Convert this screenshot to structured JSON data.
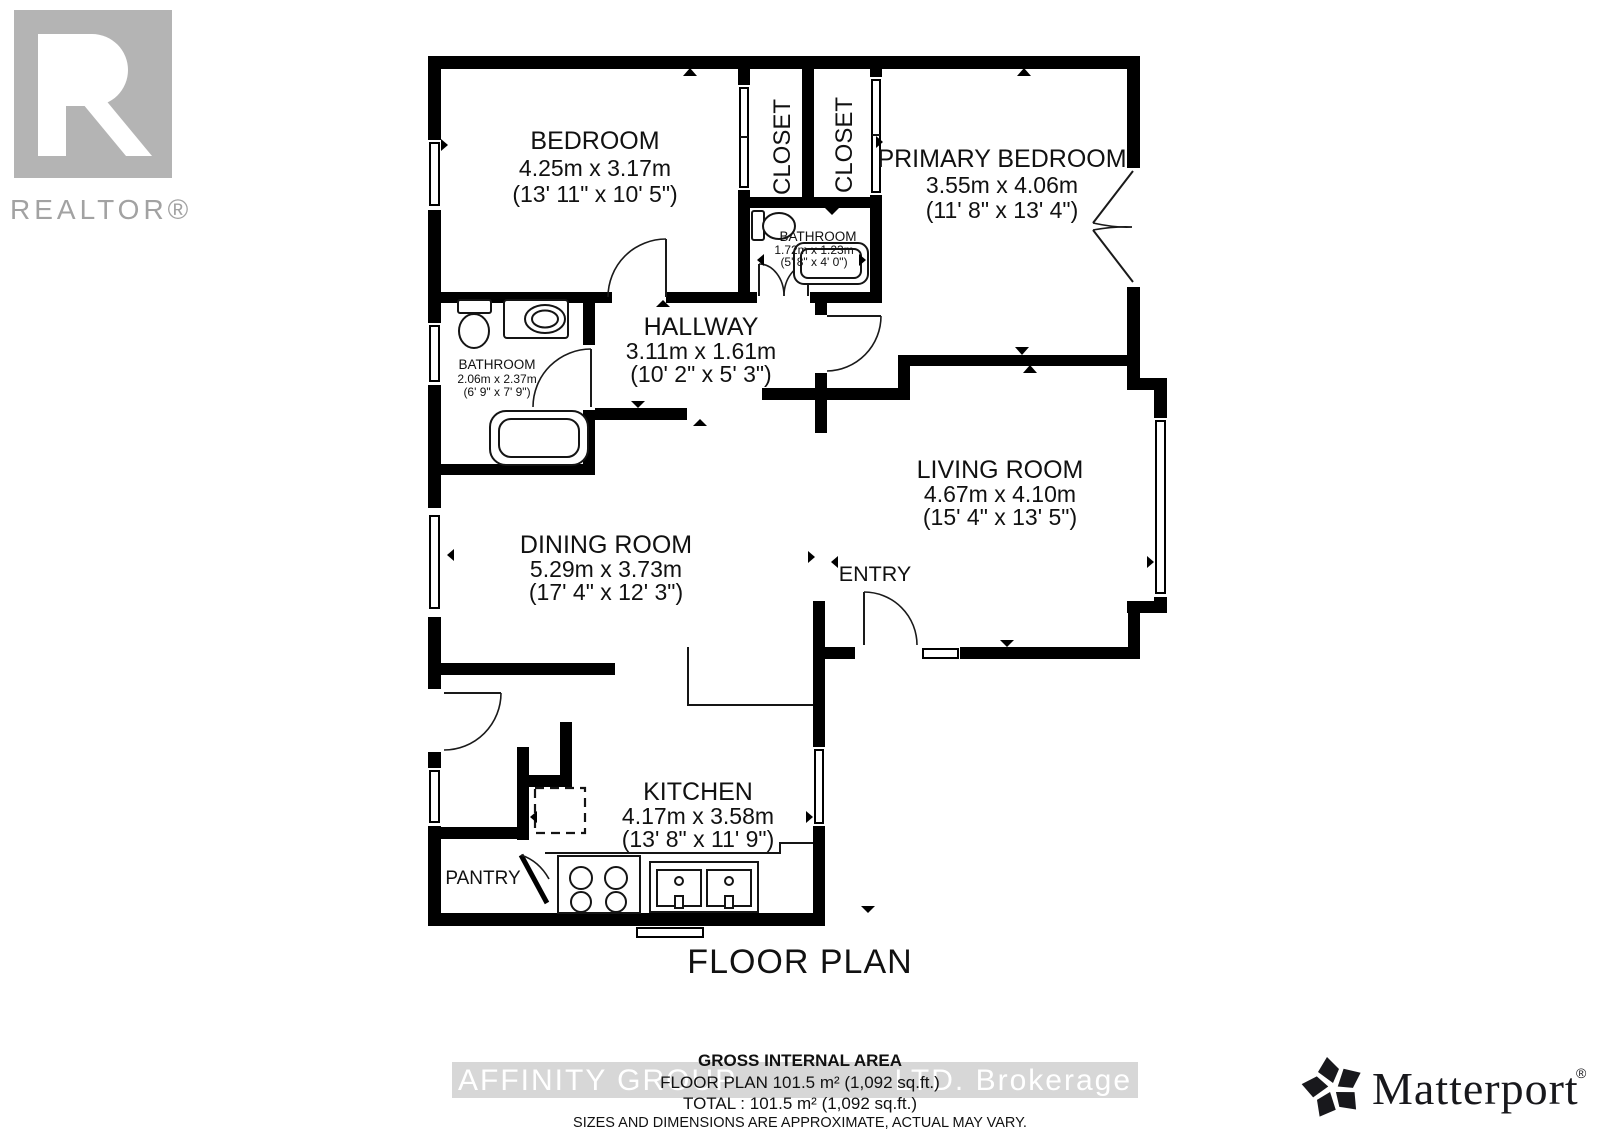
{
  "title": "FLOOR PLAN",
  "branding": {
    "realtor": {
      "wordmark": "REALTOR®"
    },
    "matterport": {
      "wordmark": "Matterport",
      "reg": "®"
    }
  },
  "rooms": {
    "bedroom": {
      "name": "BEDROOM",
      "dim_m": "4.25m x 3.17m",
      "dim_ft": "(13' 11\" x 10' 5\")"
    },
    "primary_bedroom": {
      "name": "PRIMARY BEDROOM",
      "dim_m": "3.55m x 4.06m",
      "dim_ft": "(11' 8\" x 13' 4\")"
    },
    "hallway": {
      "name": "HALLWAY",
      "dim_m": "3.11m x 1.61m",
      "dim_ft": "(10' 2\" x 5' 3\")"
    },
    "bathroom_ensuite": {
      "name": "BATHROOM",
      "dim_m": "1.72m x 1.23m",
      "dim_ft": "(5' 8\" x 4' 0\")"
    },
    "bathroom_main": {
      "name": "BATHROOM",
      "dim_m": "2.06m x 2.37m",
      "dim_ft": "(6' 9\" x 7' 9\")"
    },
    "living_room": {
      "name": "LIVING ROOM",
      "dim_m": "4.67m x 4.10m",
      "dim_ft": "(15' 4\" x 13' 5\")"
    },
    "dining_room": {
      "name": "DINING ROOM",
      "dim_m": "5.29m x 3.73m",
      "dim_ft": "(17' 4\" x 12' 3\")"
    },
    "kitchen": {
      "name": "KITCHEN",
      "dim_m": "4.17m x 3.58m",
      "dim_ft": "(13' 8\" x 11' 9\")"
    }
  },
  "labels": {
    "closet_1": "CLOSET",
    "closet_2": "CLOSET",
    "entry": "ENTRY",
    "pantry": "PANTRY"
  },
  "summary": {
    "heading": "GROSS INTERNAL AREA",
    "floor_plan_line": "FLOOR PLAN 101.5 m² (1,092 sq.ft.)",
    "total_line": "TOTAL :  101.5 m² (1,092 sq.ft.)",
    "disclaimer": "SIZES AND DIMENSIONS ARE APPROXIMATE, ACTUAL MAY VARY."
  },
  "watermark": {
    "left": "AFFINITY GROUP",
    "right": "LTD.  Brokerage"
  },
  "colors": {
    "wall": "#000000",
    "logo_gray": "#b4b4b4",
    "logo_text_gray": "#a2a2a2",
    "watermark_band": "#d7d7d7",
    "watermark_text": "#ffffff",
    "text": "#111111",
    "matterport": "#18181c"
  }
}
